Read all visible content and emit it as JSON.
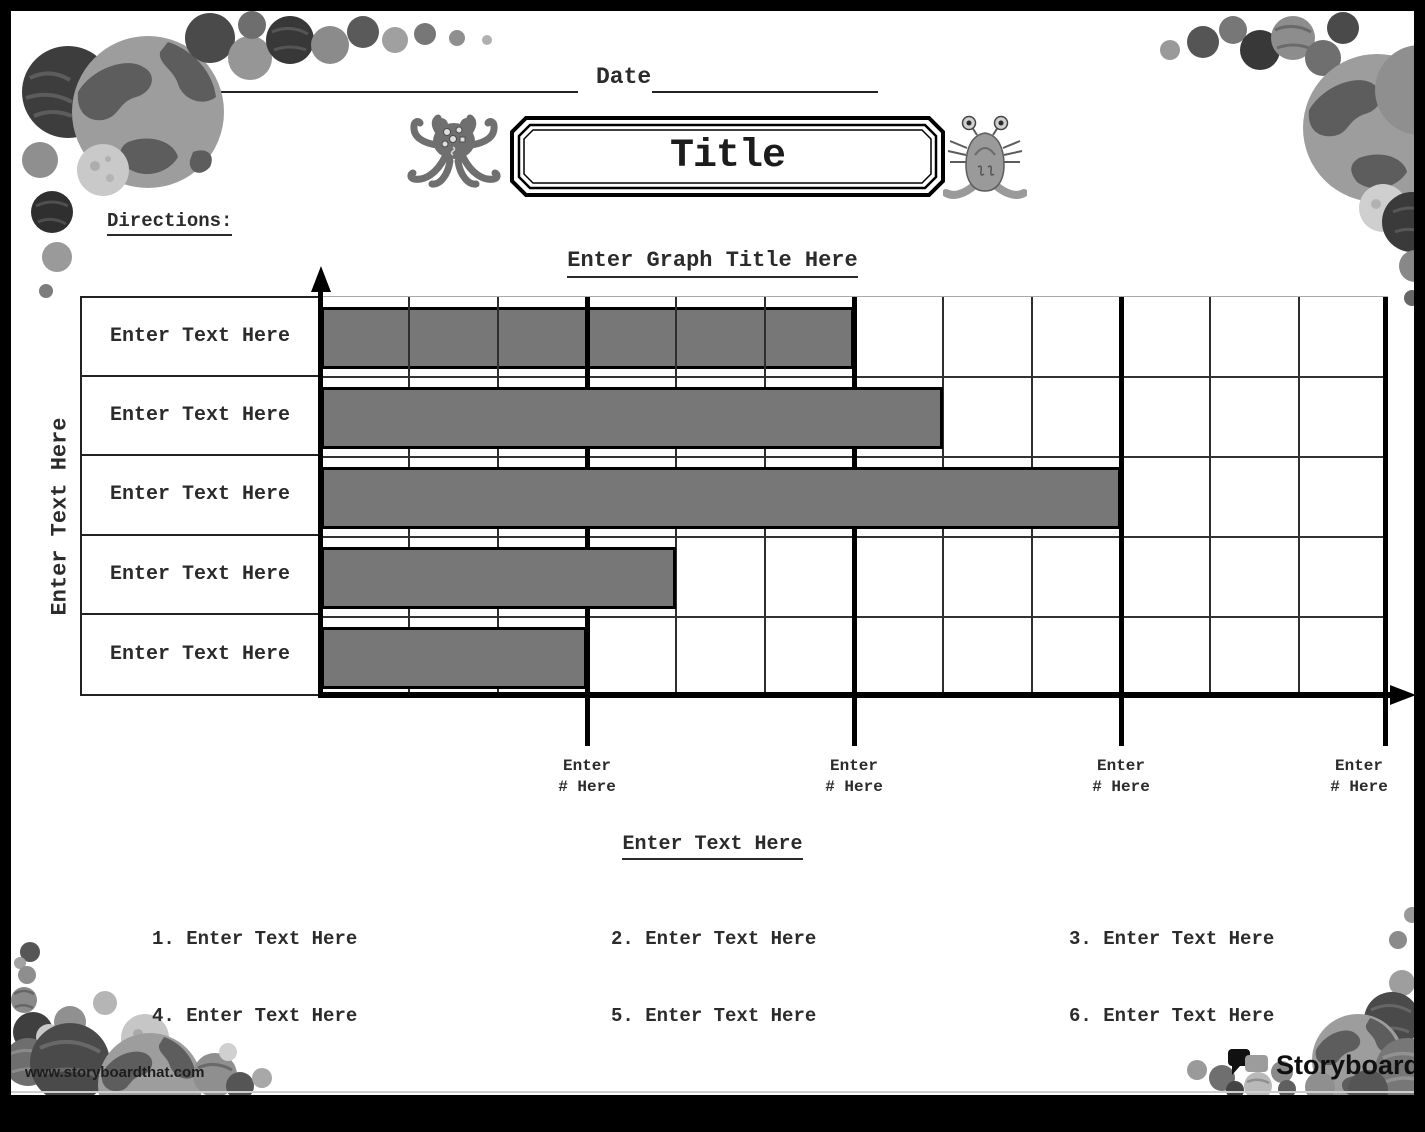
{
  "header": {
    "name_label": "Name",
    "date_label": "Date"
  },
  "title_box": {
    "title": "Title"
  },
  "directions": {
    "label": "Directions:"
  },
  "chart_data": {
    "type": "bar",
    "orientation": "horizontal",
    "title": "Enter Graph Title Here",
    "ylabel": "Enter Text Here",
    "categories": [
      "Enter Text Here",
      "Enter Text Here",
      "Enter Text Here",
      "Enter Text Here",
      "Enter Text Here"
    ],
    "values": [
      6,
      7,
      9,
      4,
      3
    ],
    "xlim": [
      0,
      12
    ],
    "minor_unit": 1,
    "major_unit": 3,
    "x_tick_labels": [
      {
        "line1": "Enter",
        "line2": "# Here"
      },
      {
        "line1": "Enter",
        "line2": "# Here"
      },
      {
        "line1": "Enter",
        "line2": "# Here"
      },
      {
        "line1": "Enter",
        "line2": "# Here"
      }
    ],
    "bar_color": "#777777",
    "grid": true,
    "legend": false
  },
  "lower": {
    "subtitle": "Enter Text Here",
    "items": [
      {
        "num": "1.",
        "text": "Enter Text Here"
      },
      {
        "num": "2.",
        "text": "Enter Text Here"
      },
      {
        "num": "3.",
        "text": "Enter Text Here"
      },
      {
        "num": "4.",
        "text": "Enter Text Here"
      },
      {
        "num": "5.",
        "text": "Enter Text Here"
      },
      {
        "num": "6.",
        "text": "Enter Text Here"
      }
    ]
  },
  "branding": {
    "url": "www.storyboardthat.com",
    "brand_word1": "Storyboard",
    "brand_word2": "That"
  },
  "colors": {
    "bar": "#777777",
    "ink": "#2b2b2b"
  }
}
